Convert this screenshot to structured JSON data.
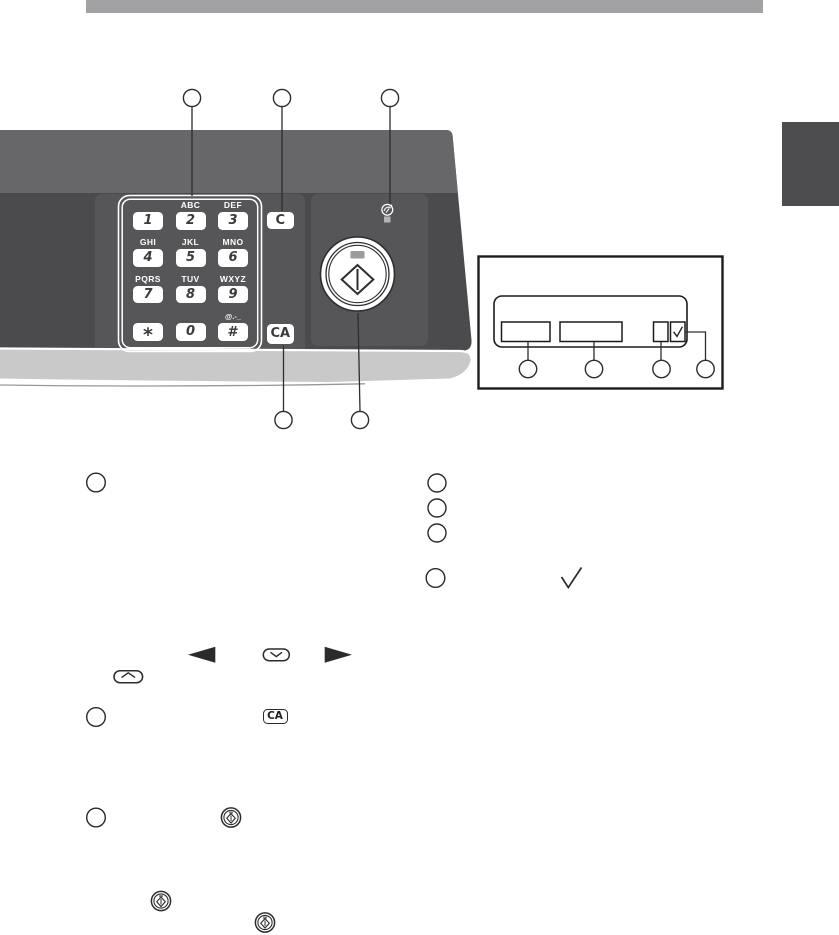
{
  "panel": {
    "keypad": {
      "keys": [
        {
          "digit": "1",
          "letters": ""
        },
        {
          "digit": "2",
          "letters": "ABC"
        },
        {
          "digit": "3",
          "letters": "DEF"
        },
        {
          "digit": "4",
          "letters": "GHI"
        },
        {
          "digit": "5",
          "letters": "JKL"
        },
        {
          "digit": "6",
          "letters": "MNO"
        },
        {
          "digit": "7",
          "letters": "PQRS"
        },
        {
          "digit": "8",
          "letters": "TUV"
        },
        {
          "digit": "9",
          "letters": "WXYZ"
        },
        {
          "digit": "*",
          "letters": ""
        },
        {
          "digit": "0",
          "letters": ""
        },
        {
          "digit": "#",
          "letters": "@.-_"
        }
      ],
      "clear_label": "C",
      "clear_all_label": "CA"
    },
    "icons": {
      "start": "start-icon",
      "energy_save": "energy-save-icon",
      "start_led": "start-led",
      "energy_save_led": "energy-save-led"
    }
  },
  "inset": {
    "icons": {
      "check": "check-icon"
    }
  },
  "body_icons": {
    "left_arrow": "left-arrow-icon",
    "right_arrow": "right-arrow-icon",
    "down_chevron_button": "chevron-down-button-icon",
    "up_chevron_button": "chevron-up-button-icon",
    "check": "check-icon",
    "clear_all_label": "CA",
    "start": "start-icon"
  },
  "colors": {
    "header_bar": "#a2a2a4",
    "side_tab": "#4d4d4f",
    "panel_body": "#4b4b4d",
    "panel_top_band": "#67676a",
    "panel_zone": "#565659",
    "bevel": "#c9c9c9",
    "key_text": "#3b3b3d",
    "line_art": "#2d2d2f"
  }
}
